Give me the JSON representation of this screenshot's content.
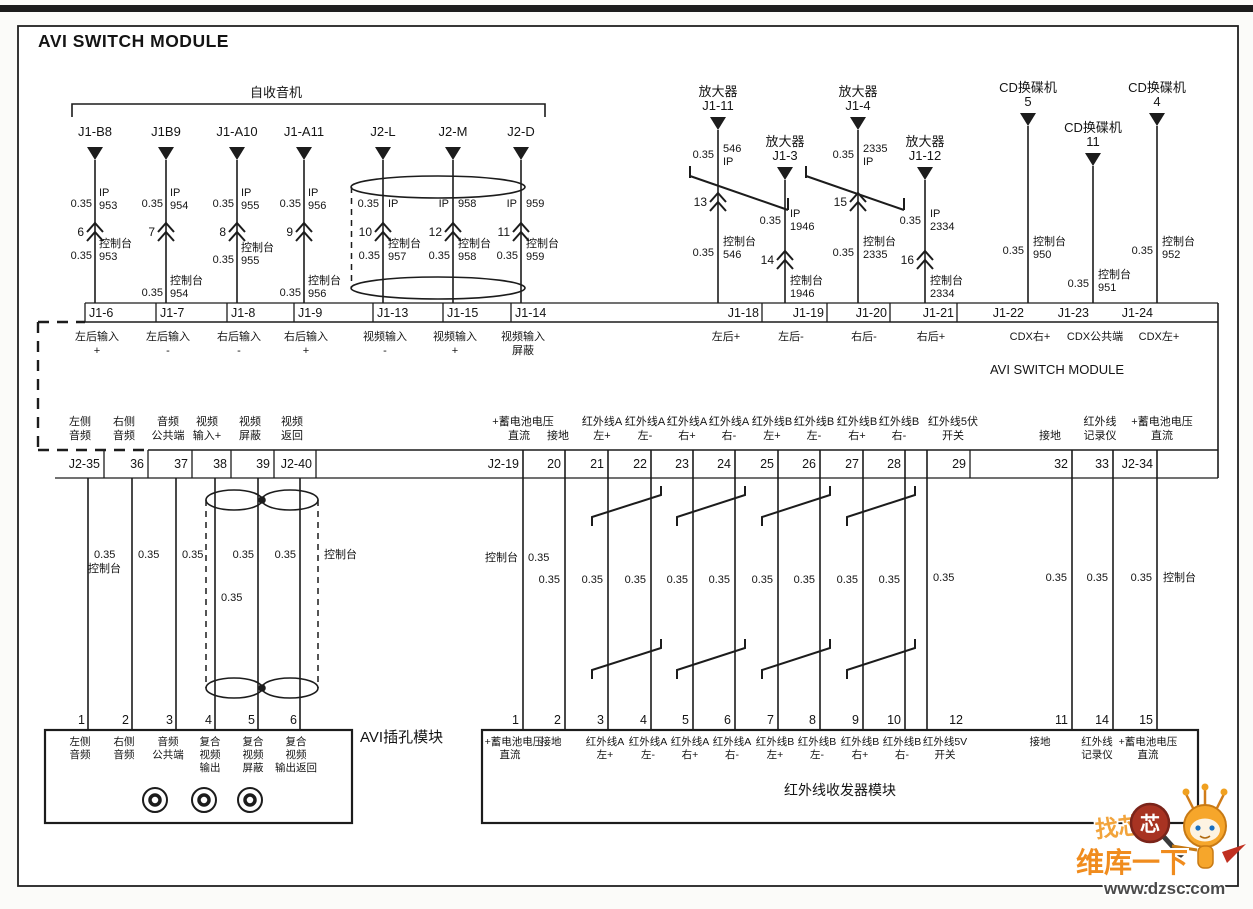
{
  "title": "AVI SWITCH MODULE",
  "common": {
    "gauge": "0.35",
    "console": "控制台"
  },
  "colors": {
    "line": "#1c1c1c",
    "paper": "#fbfbf9",
    "watermark_orange": "#f08c1e",
    "watermark_red": "#a83322"
  },
  "radio": {
    "label": "自收音机",
    "wires": [
      {
        "connector": "J1-B8",
        "gauge_top": "0.35",
        "top": [
          "IP",
          "953"
        ],
        "splice": "6",
        "gauge_bot": "0.35",
        "bot": [
          "控制台",
          "953"
        ],
        "pin": "J1-6",
        "pin_label": [
          "左后输入",
          "+"
        ]
      },
      {
        "connector": "J1B9",
        "gauge_top": "0.35",
        "top": [
          "IP",
          "954"
        ],
        "splice": "7",
        "gauge_bot": "0.35",
        "bot": [
          "控制台",
          "954"
        ],
        "pin": "J1-7",
        "pin_label": [
          "左后输入",
          "-"
        ]
      },
      {
        "connector": "J1-A10",
        "gauge_top": "0.35",
        "top": [
          "IP",
          "955"
        ],
        "splice": "8",
        "gauge_bot": "0.35",
        "bot": [
          "控制台",
          "955"
        ],
        "pin": "J1-8",
        "pin_label": [
          "右后输入",
          "-"
        ]
      },
      {
        "connector": "J1-A11",
        "gauge_top": "0.35",
        "top": [
          "IP",
          "956"
        ],
        "splice": "9",
        "gauge_bot": "0.35",
        "bot": [
          "控制台",
          "956"
        ],
        "pin": "J1-9",
        "pin_label": [
          "右后输入",
          "+"
        ]
      },
      {
        "connector": "J2-L",
        "gauge_top": "0.35",
        "top": [
          "IP"
        ],
        "splice": "10",
        "gauge_bot": "0.35",
        "bot": [
          "控制台",
          "957"
        ],
        "pin": "J1-13",
        "pin_label": [
          "视频输入",
          "-"
        ]
      },
      {
        "connector": "J2-M",
        "top": [
          "IP",
          "958"
        ],
        "splice": "12",
        "gauge_bot": "0.35",
        "bot": [
          "控制台",
          "958"
        ],
        "pin": "J1-15",
        "pin_label": [
          "视频输入",
          "+"
        ]
      },
      {
        "connector": "J2-D",
        "top": [
          "IP",
          "959"
        ],
        "splice": "11",
        "gauge_bot": "0.35",
        "bot": [
          "控制台",
          "959"
        ],
        "pin": "J1-14",
        "pin_label": [
          "视频输入",
          "屏蔽"
        ]
      }
    ]
  },
  "amp_cd": {
    "amps": [
      {
        "device": "放大器",
        "connector": "J1-11",
        "gauge_top": "0.35",
        "top": [
          "546",
          "IP"
        ],
        "splice": "13",
        "gauge_bot": "0.35",
        "bot": [
          "控制台",
          "546"
        ],
        "pin": "J1-18",
        "pin_label": "左后+"
      },
      {
        "device": "放大器",
        "connector": "J1-3",
        "gauge_top": "0.35",
        "top": [
          "IP",
          "1946"
        ],
        "splice": "14",
        "bot": [
          "控制台",
          "1946"
        ],
        "pin": "J1-19",
        "pin_label": "左后-"
      },
      {
        "device": "放大器",
        "connector": "J1-4",
        "gauge_top": "0.35",
        "top": [
          "2335",
          "IP"
        ],
        "splice": "15",
        "gauge_bot": "0.35",
        "bot": [
          "控制台",
          "2335"
        ],
        "pin": "J1-20",
        "pin_label": "右后-"
      },
      {
        "device": "放大器",
        "connector": "J1-12",
        "gauge_top": "0.35",
        "top": [
          "IP",
          "2334"
        ],
        "splice": "16",
        "bot": [
          "控制台",
          "2334"
        ],
        "pin": "J1-21",
        "pin_label": "右后+"
      }
    ],
    "cds": [
      {
        "device": "CD换碟机",
        "connector": "5",
        "gauge": "0.35",
        "circuit": [
          "控制台",
          "950"
        ],
        "pin": "J1-22",
        "pin_label": "CDX右+"
      },
      {
        "device": "CD换碟机",
        "connector": "11",
        "gauge": "0.35",
        "circuit": [
          "控制台",
          "951"
        ],
        "pin": "J1-23",
        "pin_label": "CDX公共端"
      },
      {
        "device": "CD换碟机",
        "connector": "4",
        "gauge": "0.35",
        "circuit": [
          "控制台",
          "952"
        ],
        "pin": "J1-24",
        "pin_label": "CDX左+"
      }
    ]
  },
  "module": {
    "name": "AVI SWITCH MODULE",
    "j2_left": [
      {
        "pin": "J2-35",
        "l1": "左侧",
        "l2": "音频"
      },
      {
        "pin": "36",
        "l1": "右侧",
        "l2": "音频"
      },
      {
        "pin": "37",
        "l1": "音频",
        "l2": "公共端"
      },
      {
        "pin": "38",
        "l1": "视频",
        "l2": "输入+"
      },
      {
        "pin": "39",
        "l1": "视频",
        "l2": "屏蔽"
      },
      {
        "pin": "J2-40",
        "l1": "视频",
        "l2": "返回"
      }
    ],
    "j2_right": [
      {
        "pin": "J2-19",
        "l1": "+蓄电池电压",
        "l2": "直流"
      },
      {
        "pin": "20",
        "l2": "接地"
      },
      {
        "pin": "21",
        "l1": "红外线A",
        "l2": "左+"
      },
      {
        "pin": "22",
        "l1": "红外线A",
        "l2": "左-"
      },
      {
        "pin": "23",
        "l1": "红外线A",
        "l2": "右+"
      },
      {
        "pin": "24",
        "l1": "红外线A",
        "l2": "右-"
      },
      {
        "pin": "25",
        "l1": "红外线B",
        "l2": "左+"
      },
      {
        "pin": "26",
        "l1": "红外线B",
        "l2": "左-"
      },
      {
        "pin": "27",
        "l1": "红外线B",
        "l2": "右+"
      },
      {
        "pin": "28",
        "l1": "红外线B",
        "l2": "右-"
      },
      {
        "pin": "29",
        "l1": "红外线5伏",
        "l2": "开关"
      },
      {
        "pin": "32",
        "l2": "接地"
      },
      {
        "pin": "33",
        "l1": "红外线",
        "l2": "记录仪"
      },
      {
        "pin": "J2-34",
        "l1": "+蓄电池电压",
        "l2": "直流"
      }
    ]
  },
  "jack": {
    "label": "AVI插孔模块",
    "pins": [
      {
        "n": "1",
        "lines": [
          "左侧",
          "音频"
        ]
      },
      {
        "n": "2",
        "lines": [
          "右侧",
          "音频"
        ]
      },
      {
        "n": "3",
        "lines": [
          "音频",
          "公共端"
        ]
      },
      {
        "n": "4",
        "lines": [
          "复合",
          "视频",
          "输出"
        ]
      },
      {
        "n": "5",
        "lines": [
          "复合",
          "视频",
          "屏蔽"
        ]
      },
      {
        "n": "6",
        "lines": [
          "复合",
          "视频",
          "输出返回"
        ]
      }
    ]
  },
  "ir": {
    "label": "红外线收发器模块",
    "pins": [
      {
        "n": "1",
        "lines": [
          "+蓄电池电压",
          "直流"
        ]
      },
      {
        "n": "2",
        "lines": [
          "接地"
        ]
      },
      {
        "n": "3",
        "lines": [
          "红外线A",
          "左+"
        ]
      },
      {
        "n": "4",
        "lines": [
          "红外线A",
          "左-"
        ]
      },
      {
        "n": "5",
        "lines": [
          "红外线A",
          "右+"
        ]
      },
      {
        "n": "6",
        "lines": [
          "红外线A",
          "右-"
        ]
      },
      {
        "n": "7",
        "lines": [
          "红外线B",
          "左+"
        ]
      },
      {
        "n": "8",
        "lines": [
          "红外线B",
          "左-"
        ]
      },
      {
        "n": "9",
        "lines": [
          "红外线B",
          "右+"
        ]
      },
      {
        "n": "10",
        "lines": [
          "红外线B",
          "右-"
        ]
      },
      {
        "n": "12",
        "lines": [
          "红外线5V",
          "开关"
        ]
      },
      {
        "n": "11",
        "lines": [
          "接地"
        ]
      },
      {
        "n": "14",
        "lines": [
          "红外线",
          "记录仪"
        ]
      },
      {
        "n": "15",
        "lines": [
          "+蓄电池电压",
          "直流"
        ]
      }
    ]
  },
  "watermark": {
    "slogan": "找芯片",
    "badge": "芯",
    "brand": "维库一下",
    "url": "www.dzsc.com"
  }
}
